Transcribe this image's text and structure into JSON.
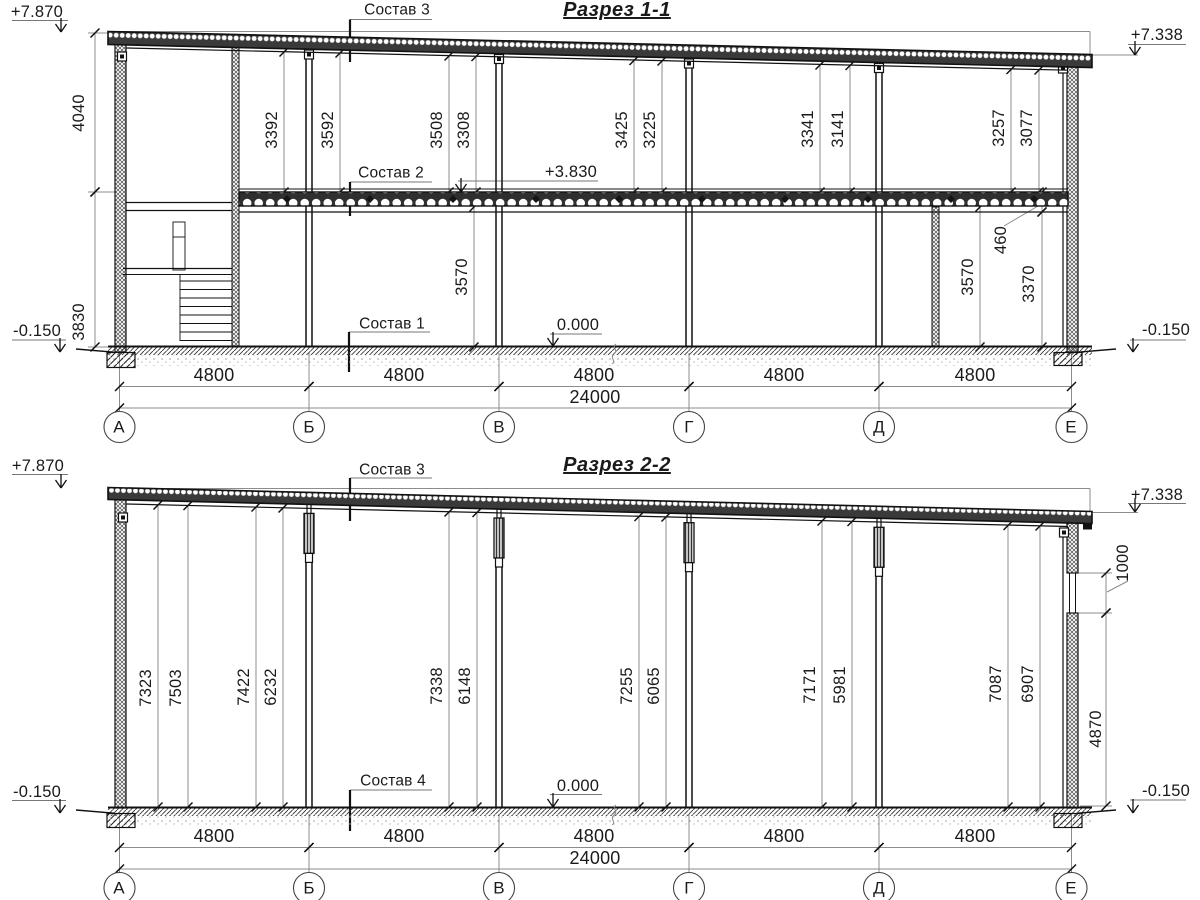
{
  "s1": {
    "title": "Разрез 1-1",
    "layers": {
      "sostav3": "Состав 3",
      "sostav2": "Состав 2",
      "sostav1": "Состав 1"
    },
    "elev": {
      "top_left": "+7.870",
      "top_right": "+7.338",
      "slab": "+3.830",
      "floor": "0.000",
      "ground_left": "-0.150",
      "ground_right": "-0.150"
    },
    "side_dims": [
      "4040",
      "3830"
    ],
    "upper_dims": [
      "3392",
      "3592",
      "3508",
      "3308",
      "3425",
      "3225",
      "3341",
      "3141",
      "3257",
      "3077"
    ],
    "lower_dims": [
      "3570",
      "3570",
      "460",
      "3370"
    ],
    "bay_dims": [
      "4800",
      "4800",
      "4800",
      "4800",
      "4800"
    ],
    "total_dim": "24000",
    "axes": [
      "А",
      "Б",
      "В",
      "Г",
      "Д",
      "Е"
    ]
  },
  "s2": {
    "title": "Разрез 2-2",
    "layers": {
      "sostav3": "Состав 3",
      "sostav4": "Состав 4"
    },
    "elev": {
      "top_left": "+7.870",
      "top_right": "+7.338",
      "floor": "0.000",
      "ground_left": "-0.150",
      "ground_right": "-0.150"
    },
    "col_dims": [
      "7323",
      "7503",
      "7422",
      "6232",
      "7338",
      "6148",
      "7255",
      "6065",
      "7171",
      "5981",
      "7087",
      "6907"
    ],
    "right_dims": [
      "1000",
      "4870"
    ],
    "bay_dims": [
      "4800",
      "4800",
      "4800",
      "4800",
      "4800"
    ],
    "total_dim": "24000",
    "axes": [
      "А",
      "Б",
      "В",
      "Г",
      "Д",
      "Е"
    ]
  }
}
